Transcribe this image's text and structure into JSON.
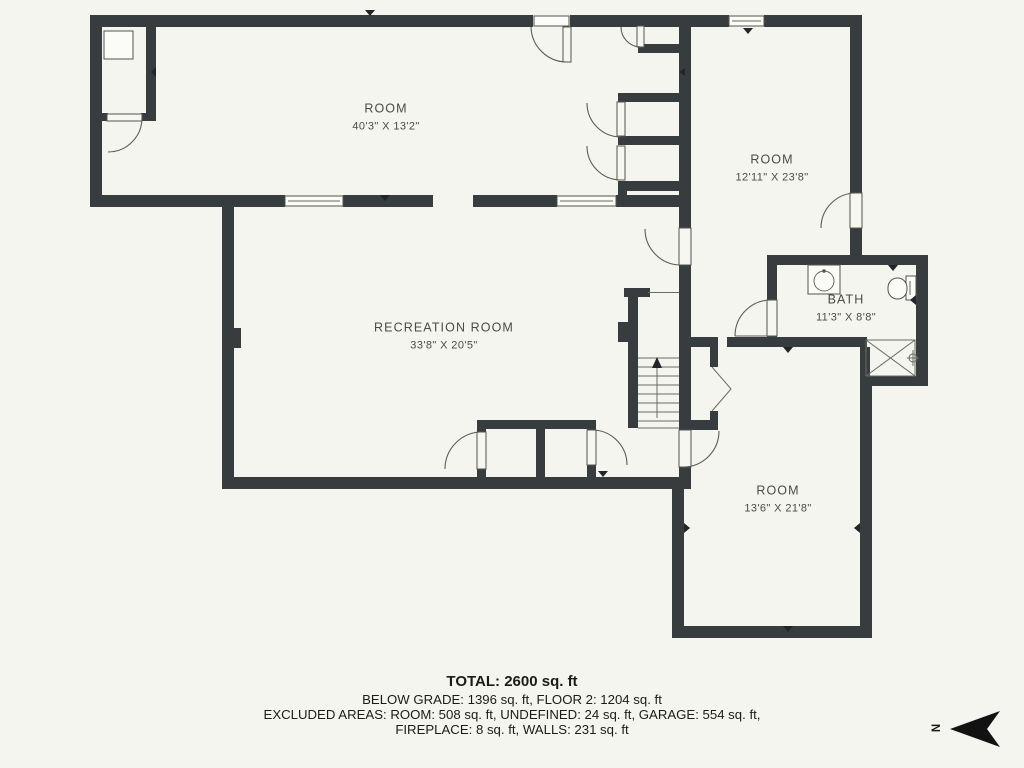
{
  "rooms": [
    {
      "id": "room-top-left",
      "name": "ROOM",
      "dims": "40'3\" X 13'2\""
    },
    {
      "id": "room-top-right",
      "name": "ROOM",
      "dims": "12'11\" X 23'8\""
    },
    {
      "id": "recreation-room",
      "name": "RECREATION ROOM",
      "dims": "33'8\" X 20'5\""
    },
    {
      "id": "bath",
      "name": "BATH",
      "dims": "11'3\" X 8'8\""
    },
    {
      "id": "room-bottom-right",
      "name": "ROOM",
      "dims": "13'6\" X 21'8\""
    }
  ],
  "summary": {
    "total": "TOTAL: 2600 sq. ft",
    "grades": "BELOW GRADE: 1396 sq. ft, FLOOR 2: 1204 sq. ft",
    "excluded_1": "EXCLUDED AREAS: ROOM: 508 sq. ft, UNDEFINED: 24 sq. ft, GARAGE: 554 sq. ft,",
    "excluded_2": "FIREPLACE: 8 sq. ft, WALLS: 231 sq. ft"
  },
  "compass": {
    "label": "N"
  },
  "colors": {
    "wall": "#373c3f",
    "background": "#f5f5f0",
    "line": "#5d5d56",
    "text": "#4b4b45"
  }
}
